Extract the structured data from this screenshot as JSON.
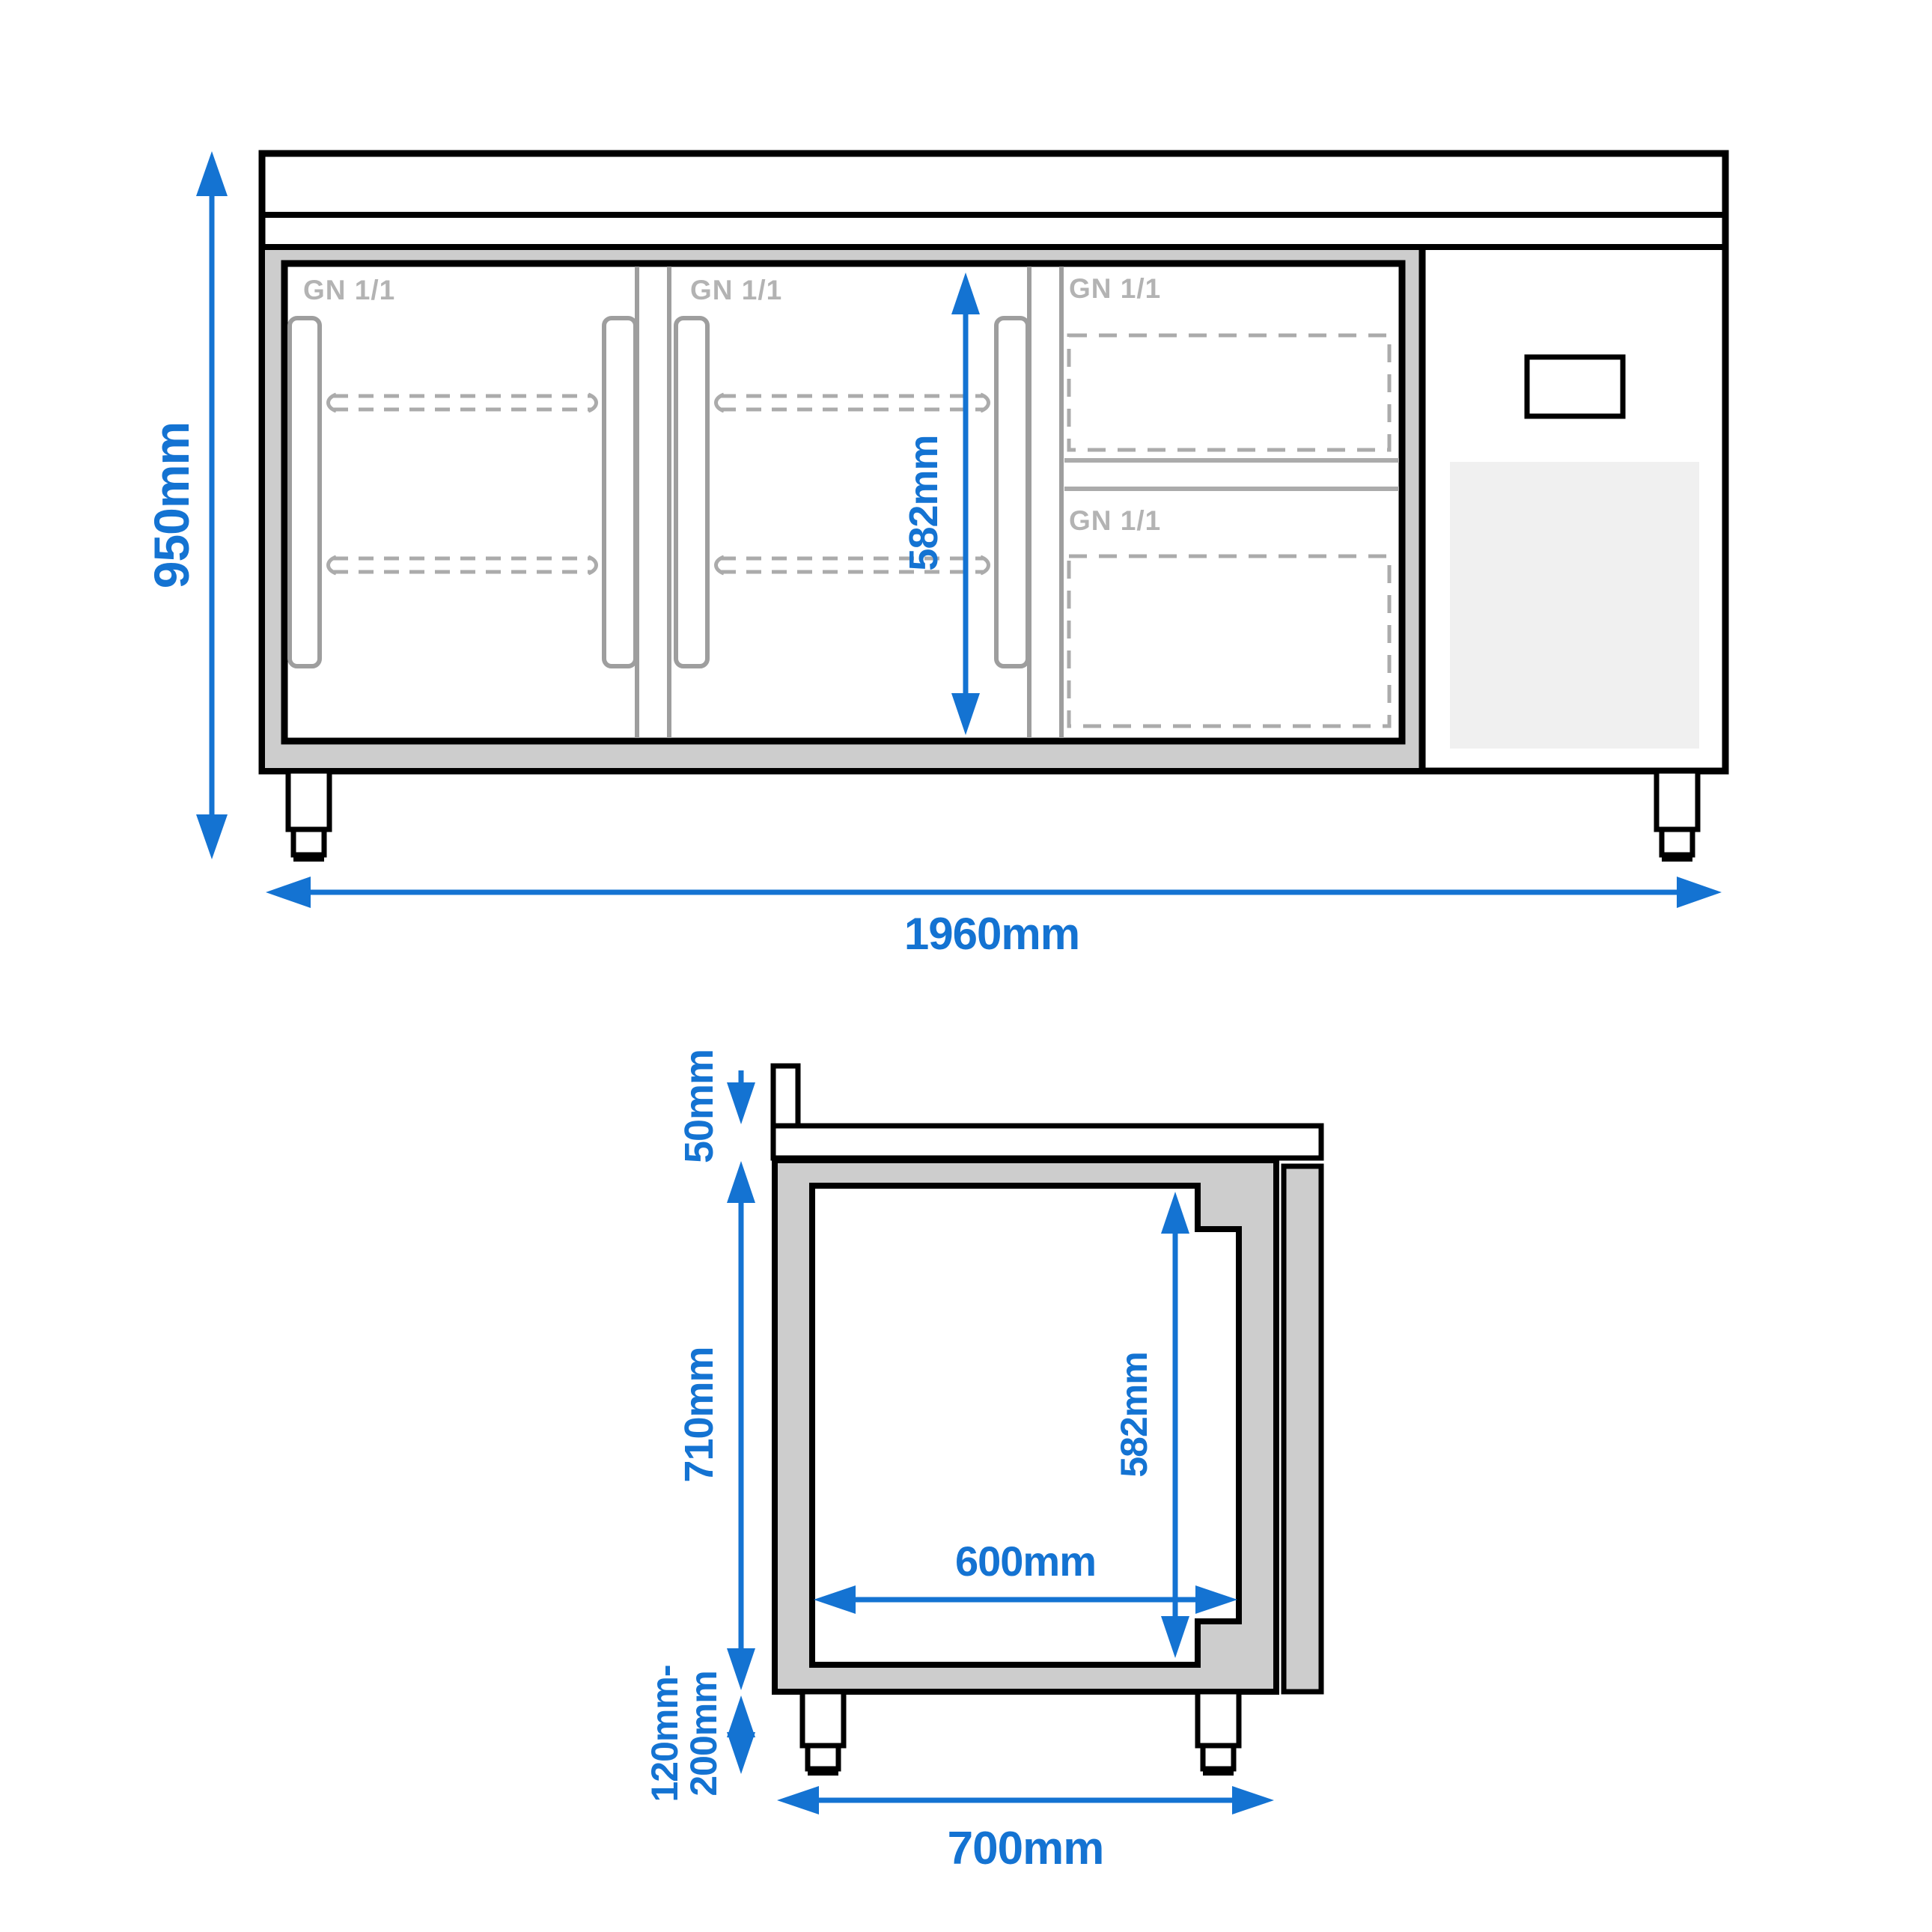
{
  "title": "Refrigerated counter technical dimension drawing",
  "colors": {
    "accent_blue": "#1473d2",
    "outline_black": "#000000",
    "body_gray": "#cdcdcd",
    "vent_panel_gray": "#f0f0f0",
    "gn_label_gray": "#b3b3b3",
    "detail_gray": "#9e9e9e",
    "dash_gray": "#ababab",
    "background": "#ffffff"
  },
  "front_view": {
    "label": "Front view",
    "gn_door_1": "GN 1/1",
    "gn_door_2": "GN 1/1",
    "gn_drawer_top": "GN 1/1",
    "gn_drawer_bottom": "GN 1/1",
    "dim_height": "950mm",
    "dim_width": "1960mm",
    "dim_inner_height": "582mm"
  },
  "side_view": {
    "label": "Side view",
    "dim_worktop": "50mm",
    "dim_body_height": "710mm",
    "dim_inner_height": "582mm",
    "dim_inner_width": "600mm",
    "dim_feet_line1": "120mm-",
    "dim_feet_line2": "200mm",
    "dim_depth": "700mm"
  }
}
